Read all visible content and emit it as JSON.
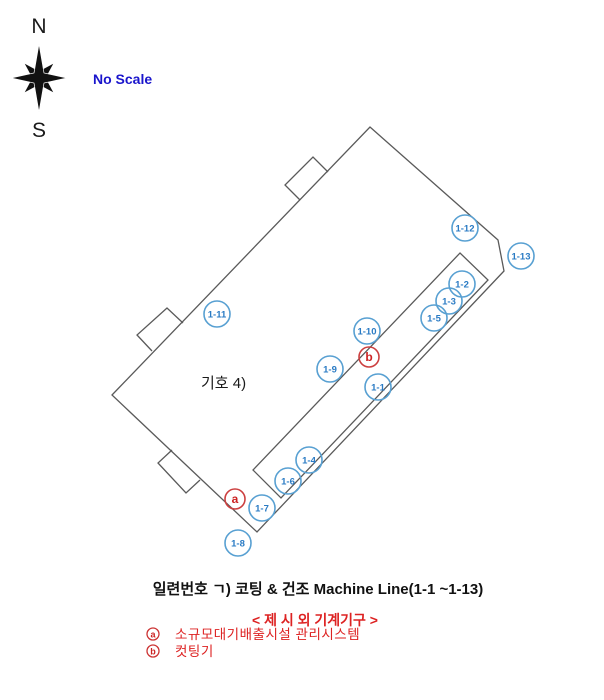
{
  "compass": {
    "north": "N",
    "south": "S"
  },
  "scale_note": "No Scale",
  "building": {
    "room_label": "기호 4)"
  },
  "markers": [
    {
      "id": "1-1",
      "x": 378,
      "y": 387,
      "type": "machine"
    },
    {
      "id": "1-2",
      "x": 462,
      "y": 284,
      "type": "machine"
    },
    {
      "id": "1-3",
      "x": 449,
      "y": 301,
      "type": "machine"
    },
    {
      "id": "1-4",
      "x": 309,
      "y": 460,
      "type": "machine"
    },
    {
      "id": "1-5",
      "x": 434,
      "y": 318,
      "type": "machine"
    },
    {
      "id": "1-6",
      "x": 288,
      "y": 481,
      "type": "machine"
    },
    {
      "id": "1-7",
      "x": 262,
      "y": 508,
      "type": "machine"
    },
    {
      "id": "1-8",
      "x": 238,
      "y": 543,
      "type": "machine"
    },
    {
      "id": "1-9",
      "x": 330,
      "y": 369,
      "type": "machine"
    },
    {
      "id": "1-10",
      "x": 367,
      "y": 331,
      "type": "machine"
    },
    {
      "id": "1-11",
      "x": 217,
      "y": 314,
      "type": "machine"
    },
    {
      "id": "1-12",
      "x": 465,
      "y": 228,
      "type": "machine"
    },
    {
      "id": "1-13",
      "x": 521,
      "y": 256,
      "type": "machine"
    },
    {
      "id": "a",
      "x": 235,
      "y": 499,
      "type": "annex"
    },
    {
      "id": "b",
      "x": 369,
      "y": 357,
      "type": "annex"
    }
  ],
  "caption": {
    "title": "일련번호 ㄱ) 코팅 & 건조 Machine Line(1-1 ~1-13)",
    "subtitle": "< 제 시 외 기계기구 >",
    "legend": [
      {
        "symbol": "a",
        "label": "소규모대기배출시설 관리시스템"
      },
      {
        "symbol": "b",
        "label": "컷팅기"
      }
    ]
  },
  "colors": {
    "machine_stroke": "#58a0d2",
    "machine_text": "#2a7bc4",
    "annex_red": "#cc3333",
    "scale_blue": "#1a15cc",
    "caption_red": "#dd2222",
    "line_gray": "#5a5a5a"
  }
}
